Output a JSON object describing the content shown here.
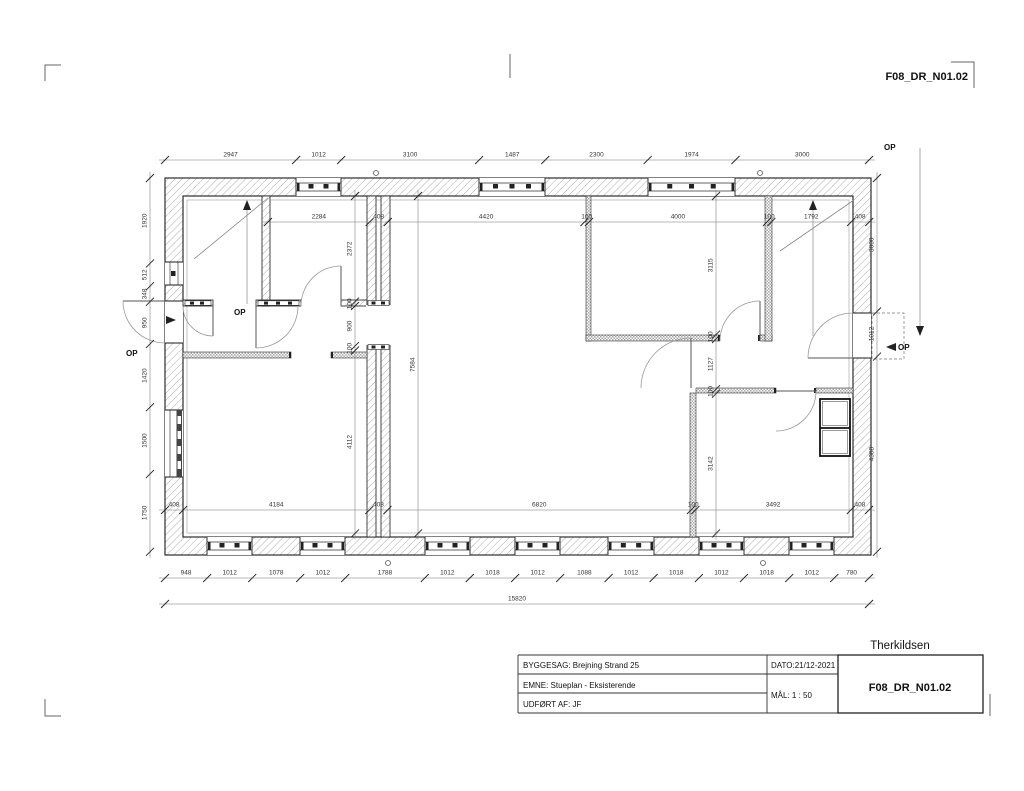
{
  "header": {
    "drawing_number": "F08_DR_N01.02"
  },
  "title_block": {
    "company": "Therkildsen",
    "project": "BYGGESAG: Brejning Strand 25",
    "subject": "EMNE: Stueplan - Eksisterende",
    "author": "UDFØRT AF: JF",
    "date": "DATO:21/12-2021",
    "scale": "MÅL:  1 : 50",
    "drawing_number": "F08_DR_N01.02"
  },
  "labels": {
    "op": "OP"
  },
  "dimensions": {
    "top_outer": {
      "values": [
        2947,
        1012,
        3100,
        1487,
        2300,
        1974,
        3000
      ]
    },
    "top_inner": {
      "values": [
        2284,
        408,
        4420,
        100,
        4000,
        100,
        1792,
        408
      ]
    },
    "bottom_inner": {
      "values": [
        408,
        4184,
        408,
        6820,
        100,
        3492,
        408
      ]
    },
    "bottom_outer": {
      "values": [
        948,
        1012,
        1078,
        1012,
        1788,
        1012,
        1018,
        1012,
        1088,
        1012,
        1018,
        1012,
        1018,
        1012,
        780
      ]
    },
    "bottom_total": {
      "values": [
        15820
      ]
    },
    "left_outer": {
      "values": [
        1920,
        512,
        348,
        950,
        1420,
        1500,
        1750
      ]
    },
    "left_inner": {
      "values": [
        2372,
        100,
        900,
        100,
        4112
      ]
    },
    "hall_depth": {
      "values": [
        7584
      ]
    },
    "right_inner": {
      "values": [
        3115,
        100,
        1127,
        100,
        3142
      ]
    },
    "right_outer": {
      "values": [
        3000,
        1012,
        4388
      ]
    }
  }
}
